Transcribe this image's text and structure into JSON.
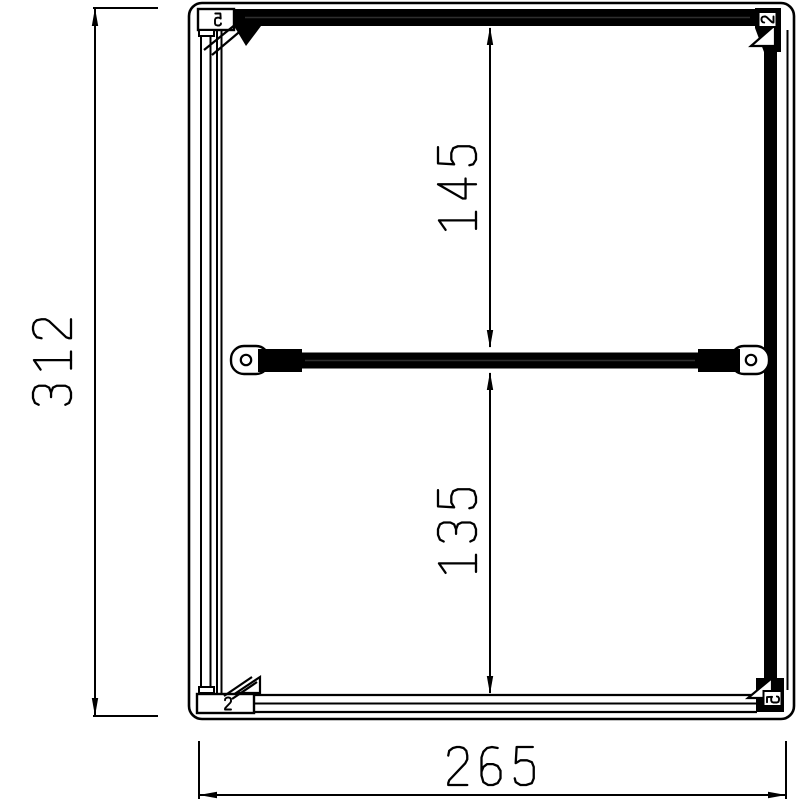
{
  "drawing": {
    "type": "technical-cad-drawing",
    "background_color": "#ffffff",
    "line_color": "#000000",
    "dimensions": {
      "overall_height": "312",
      "overall_width": "265",
      "upper_opening_height": "145",
      "lower_opening_height": "135"
    },
    "corner_marks": {
      "top_left": "5",
      "top_right": "2",
      "bottom_left": "2",
      "bottom_right": "5"
    }
  }
}
